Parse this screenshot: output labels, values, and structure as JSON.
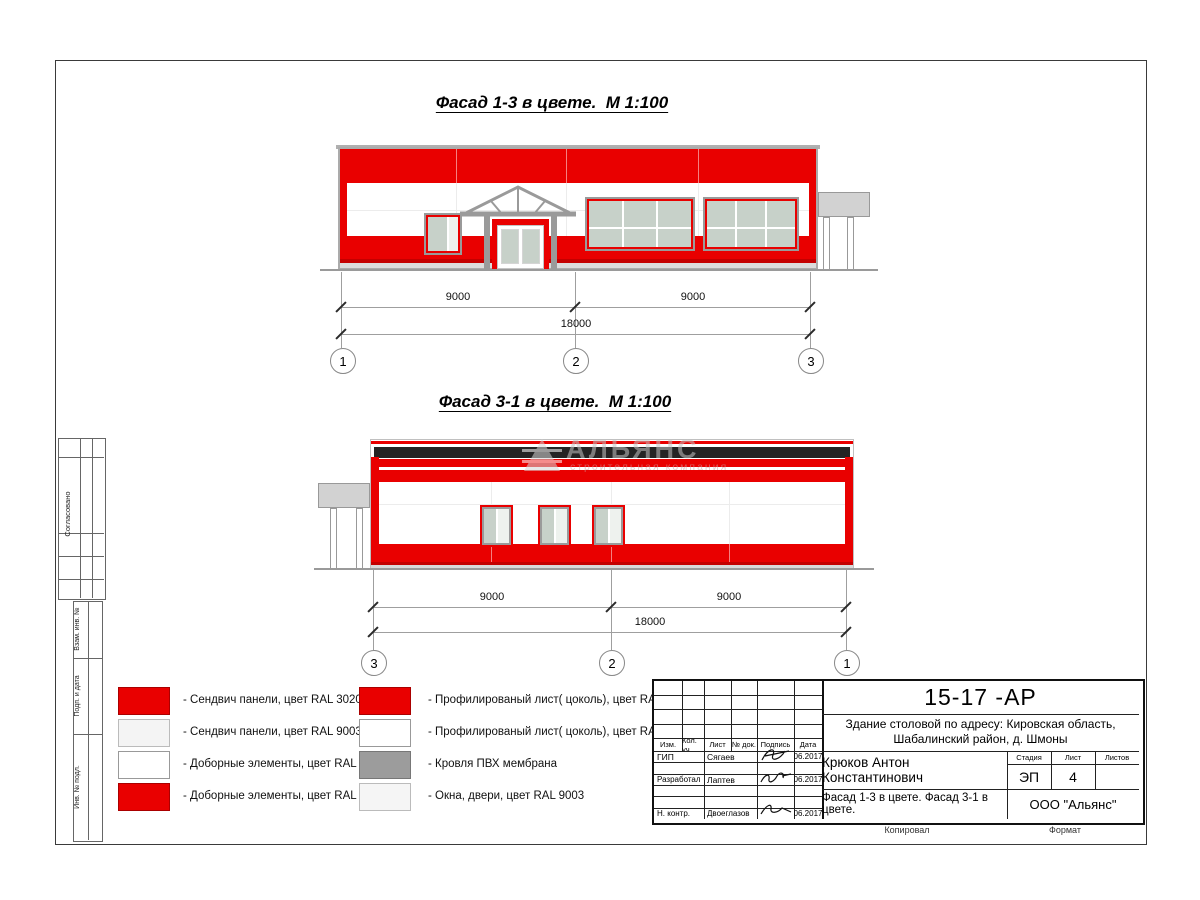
{
  "colors": {
    "red": "#e90000",
    "red_dark": "#c40000",
    "black_band": "#242424",
    "glass": "#c7d1c9",
    "frame_gray": "#9a9a9a",
    "canopy_gray": "#d2d2d2",
    "joint_gray": "#ececec",
    "line_gray": "#9f9f9f"
  },
  "titles": {
    "facade13": "Фасад 1-3 в цвете.  М 1:100",
    "facade31": "Фасад 3-1 в цвете.  М 1:100"
  },
  "dims_facade13": {
    "seg1": "9000",
    "seg2": "9000",
    "total": "18000",
    "axes": [
      "1",
      "2",
      "3"
    ]
  },
  "dims_facade31": {
    "seg1": "9000",
    "seg2": "9000",
    "total": "18000",
    "axes": [
      "3",
      "2",
      "1"
    ]
  },
  "watermark": {
    "name": "АЛЬЯНС",
    "tagline": "строительная компания"
  },
  "legend": {
    "column1": [
      {
        "label": "- Сендвич панели, цвет RAL 3020",
        "swatch": "#e90000"
      },
      {
        "label": "- Сендвич панели, цвет RAL 9003",
        "swatch": "#f4f4f4"
      },
      {
        "label": "- Доборные элементы, цвет RAL 9003",
        "swatch": "#ffffff"
      },
      {
        "label": "- Доборные элементы, цвет RAL 3020",
        "swatch": "#e90000"
      }
    ],
    "column2": [
      {
        "label": "- Профилированый лист( цоколь), цвет RAL 3020",
        "swatch": "#e90000"
      },
      {
        "label": "- Профилированый лист( цоколь), цвет RAL 9003",
        "swatch": "#ffffff"
      },
      {
        "label": "- Кровля ПВХ мембрана",
        "swatch": "#9c9c9c"
      },
      {
        "label": "- Окна, двери, цвет RAL 9003",
        "swatch": "#f5f5f5"
      }
    ]
  },
  "margin_labels": {
    "approved": "Согласовано",
    "vzam": "Взам. инв. №",
    "podp": "Подп. и дата",
    "inv": "Инв. № подл."
  },
  "title_block": {
    "doc_number": "15-17 -АР",
    "project_line1": "Здание столовой по адресу: Кировская область,",
    "project_line2": "Шабалинский район, д. Шмоны",
    "headers": {
      "izm": "Изм.",
      "kol": "Кол. уч.",
      "list": "Лист",
      "doc": "№ док.",
      "sign": "Подпись",
      "date": "Дата"
    },
    "rows": [
      {
        "role": "ГИП",
        "name": "Сягаев",
        "date": "06.2017"
      },
      {
        "role": "Разработал",
        "name": "Лаптев",
        "date": "06.2017"
      },
      {
        "role": "Н. контр.",
        "name": "Двоеглазов",
        "date": "06.2017"
      }
    ],
    "chief": "Крюков Антон Константинович",
    "stage_header": {
      "stage": "Стадия",
      "sheet": "Лист",
      "sheets": "Листов"
    },
    "stage": "ЭП",
    "sheet_no": "4",
    "sheets_total": "",
    "sheet_title": "Фасад 1-3 в цвете. Фасад 3-1 в цвете.",
    "company": "ООО \"Альянс\"",
    "footer": {
      "copied": "Копировал",
      "format": "Формат"
    }
  }
}
